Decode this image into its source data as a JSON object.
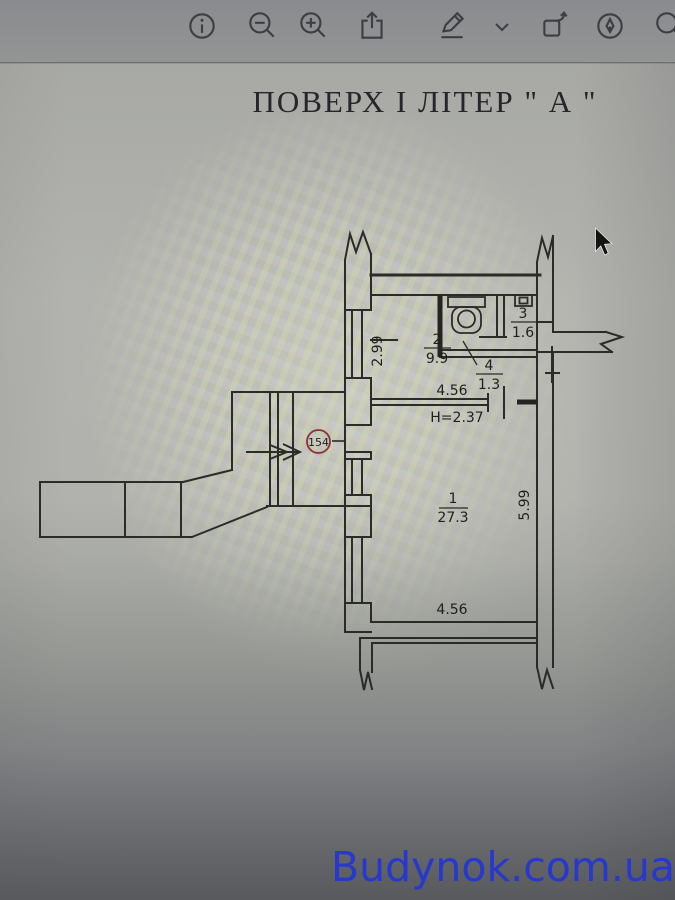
{
  "app": {
    "toolbar": {
      "icons": [
        {
          "name": "info"
        },
        {
          "name": "zoom-out"
        },
        {
          "name": "zoom-in"
        },
        {
          "name": "share"
        },
        {
          "name": "markup"
        },
        {
          "name": "markup-expand"
        },
        {
          "name": "rotate"
        },
        {
          "name": "highlight"
        },
        {
          "name": "search"
        }
      ]
    }
  },
  "document": {
    "title": "ПОВЕРХ І  ЛІТЕР  \" А \"",
    "plan": {
      "apartment_number": "154",
      "ceiling_height_label": "H=2.37",
      "rooms": [
        {
          "number": "1",
          "area": "27.3"
        },
        {
          "number": "2",
          "area": "9.9"
        },
        {
          "number": "3",
          "area": "1.6"
        },
        {
          "number": "4",
          "area": "1.3"
        }
      ],
      "dimensions": {
        "upper_width": "4.56",
        "lower_width": "4.56",
        "left_wall": "2.99",
        "right_wall": "5.99"
      }
    },
    "watermark": "Budynok.com.ua"
  },
  "colors": {
    "toolbar_icon": "#3c3e42",
    "plan_line": "#2b2b28",
    "apartment_badge": "#8b3137",
    "watermark_blue": "#2638cd"
  }
}
